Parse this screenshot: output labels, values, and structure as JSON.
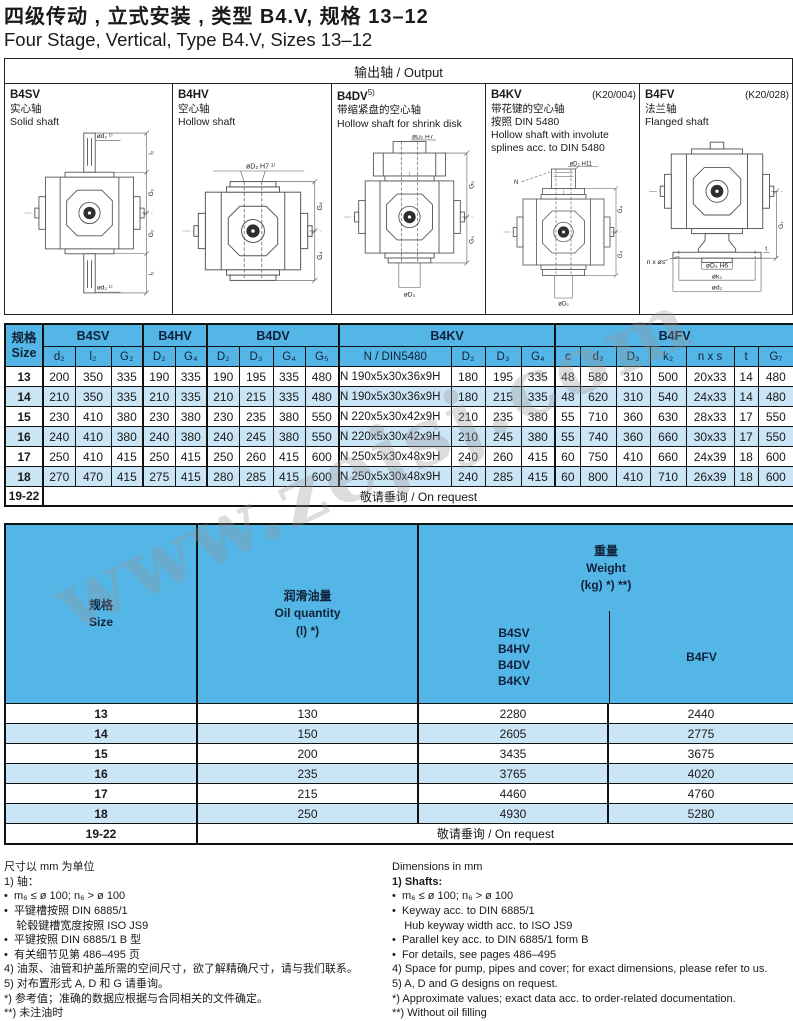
{
  "title": {
    "cn": "四级传动 , 立式安装 , 类型 B4.V, 规格 13–12",
    "en": "Four Stage, Vertical, Type B4.V, Sizes 13–12"
  },
  "watermark": {
    "text": "www.zejsj.com"
  },
  "output": {
    "header": "输出轴 / Output",
    "panels": [
      {
        "code": "B4SV",
        "sup": "",
        "ref": "",
        "lines": [
          "实心轴",
          "Solid shaft"
        ],
        "svg_labels": {
          "top": "ød₂ ¹⁾",
          "d1": "l₂",
          "d2": "G₂",
          "d3": "G₂",
          "d4": "l₂",
          "bottom": "ød₂ ¹⁾"
        }
      },
      {
        "code": "B4HV",
        "sup": "",
        "ref": "",
        "lines": [
          "空心轴",
          "Hollow shaft"
        ],
        "svg_labels": {
          "top": "øD₂ H7 ¹⁾",
          "d1": "G₄",
          "d2": "G₄"
        }
      },
      {
        "code": "B4DV",
        "sup": "5)",
        "ref": "",
        "lines": [
          "带缩紧盘的空心轴",
          "Hollow shaft for shrink disk"
        ],
        "svg_labels": {
          "top": "øD₂ H7",
          "d1": "G₅",
          "d2": "G₄",
          "bottom": "øD₃"
        }
      },
      {
        "code": "B4KV",
        "sup": "",
        "ref": "(K20/004)",
        "lines": [
          "带花键的空心轴",
          "按照 DIN 5480",
          "Hollow shaft with involute",
          "splines acc. to DIN 5480"
        ],
        "svg_labels": {
          "n": "N",
          "top": "øD₂ H11",
          "d1": "G₄",
          "d2": "G₄",
          "bottom": "øD₃"
        }
      },
      {
        "code": "B4FV",
        "sup": "",
        "ref": "(K20/028)",
        "lines": [
          "法兰轴",
          "Flanged shaft"
        ],
        "svg_labels": {
          "d1": "G₇",
          "f1": "øD₃ H6",
          "f2": "øk₂",
          "f3": "ød₂",
          "left": "n x øs",
          "t": "t"
        }
      }
    ]
  },
  "table1": {
    "size_header": {
      "cn": "规格",
      "en": "Size"
    },
    "groups": [
      "B4SV",
      "B4HV",
      "B4DV",
      "B4KV",
      "B4FV"
    ],
    "subheaders": [
      "d₂",
      "l₂",
      "G₂",
      "D₂",
      "G₄",
      "D₂",
      "D₃",
      "G₄",
      "G₅",
      "N / DIN5480",
      "D₂",
      "D₃",
      "G₄",
      "c",
      "d₂",
      "D₃",
      "k₂",
      "n x s",
      "t",
      "G₇"
    ],
    "rows": [
      {
        "size": "13",
        "values": [
          "200",
          "350",
          "335",
          "190",
          "335",
          "190",
          "195",
          "335",
          "480",
          "N 190x5x30x36x9H",
          "180",
          "195",
          "335",
          "48",
          "580",
          "310",
          "500",
          "20x33",
          "14",
          "480"
        ]
      },
      {
        "size": "14",
        "values": [
          "210",
          "350",
          "335",
          "210",
          "335",
          "210",
          "215",
          "335",
          "480",
          "N 190x5x30x36x9H",
          "180",
          "215",
          "335",
          "48",
          "620",
          "310",
          "540",
          "24x33",
          "14",
          "480"
        ]
      },
      {
        "size": "15",
        "values": [
          "230",
          "410",
          "380",
          "230",
          "380",
          "230",
          "235",
          "380",
          "550",
          "N 220x5x30x42x9H",
          "210",
          "235",
          "380",
          "55",
          "710",
          "360",
          "630",
          "28x33",
          "17",
          "550"
        ]
      },
      {
        "size": "16",
        "values": [
          "240",
          "410",
          "380",
          "240",
          "380",
          "240",
          "245",
          "380",
          "550",
          "N 220x5x30x42x9H",
          "210",
          "245",
          "380",
          "55",
          "740",
          "360",
          "660",
          "30x33",
          "17",
          "550"
        ]
      },
      {
        "size": "17",
        "values": [
          "250",
          "410",
          "415",
          "250",
          "415",
          "250",
          "260",
          "415",
          "600",
          "N 250x5x30x48x9H",
          "240",
          "260",
          "415",
          "60",
          "750",
          "410",
          "660",
          "24x39",
          "18",
          "600"
        ]
      },
      {
        "size": "18",
        "values": [
          "270",
          "470",
          "415",
          "275",
          "415",
          "280",
          "285",
          "415",
          "600",
          "N 250x5x30x48x9H",
          "240",
          "285",
          "415",
          "60",
          "800",
          "410",
          "710",
          "26x39",
          "18",
          "600"
        ]
      }
    ],
    "request": {
      "size": "19-22",
      "label": "敬请垂询 / On request"
    }
  },
  "table2": {
    "size_header": {
      "cn": "规格",
      "en": "Size"
    },
    "oil_header": {
      "cn": "润滑油量",
      "en": "Oil quantity",
      "unit": "(l) *)"
    },
    "weight_header": {
      "cn": "重量",
      "en": "Weight",
      "unit": "(kg) *) **)"
    },
    "weight_col1": [
      "B4SV",
      "B4HV",
      "B4DV",
      "B4KV"
    ],
    "weight_col2": "B4FV",
    "rows": [
      {
        "size": "13",
        "values": [
          "130",
          "2280",
          "2440"
        ]
      },
      {
        "size": "14",
        "values": [
          "150",
          "2605",
          "2775"
        ]
      },
      {
        "size": "15",
        "values": [
          "200",
          "3435",
          "3675"
        ]
      },
      {
        "size": "16",
        "values": [
          "235",
          "3765",
          "4020"
        ]
      },
      {
        "size": "17",
        "values": [
          "215",
          "4460",
          "4760"
        ]
      },
      {
        "size": "18",
        "values": [
          "250",
          "4930",
          "5280"
        ]
      }
    ],
    "request": {
      "size": "19-22",
      "label": "敬请垂询 / On request"
    }
  },
  "footnotes": {
    "cn": [
      {
        "t": "尺寸以 mm 为单位",
        "b": false
      },
      {
        "t": "1) 轴：",
        "b": false
      },
      {
        "t": "•  m₆ ≤ ø 100; n₆ > ø 100",
        "b": false
      },
      {
        "t": "•  平键槽按照 DIN 6885/1",
        "b": false
      },
      {
        "t": "    轮毂键槽宽度按照 ISO JS9",
        "b": false
      },
      {
        "t": "•  平键按照 DIN 6885/1 B 型",
        "b": false
      },
      {
        "t": "•  有关细节见第 486–495 页",
        "b": false
      },
      {
        "t": "4) 油泵、油管和护盖所需的空间尺寸，欲了解精确尺寸，请与我们联系。",
        "b": false
      },
      {
        "t": "5) 对布置形式 A, D 和 G 请垂询。",
        "b": false
      },
      {
        "t": "*) 参考值；准确的数据应根据与合同相关的文件确定。",
        "b": false
      },
      {
        "t": "**) 未注油时",
        "b": false
      }
    ],
    "en": [
      {
        "t": "Dimensions in mm",
        "b": false
      },
      {
        "t": "1) Shafts:",
        "b": true
      },
      {
        "t": "•  m₆ ≤ ø 100; n₆ > ø 100",
        "b": false
      },
      {
        "t": "•  Keyway acc. to DIN 6885/1",
        "b": false
      },
      {
        "t": "    Hub keyway width acc. to ISO JS9",
        "b": false
      },
      {
        "t": "•  Parallel key acc. to DIN 6885/1 form B",
        "b": false
      },
      {
        "t": "•  For details, see pages 486–495",
        "b": false
      },
      {
        "t": "4) Space for pump, pipes and cover; for exact dimensions, please refer to us.",
        "b": false
      },
      {
        "t": "5) A, D and G designs on request.",
        "b": false
      },
      {
        "t": "*) Approximate values; exact data acc. to order-related documentation.",
        "b": false
      },
      {
        "t": "**) Without oil filling",
        "b": false
      }
    ]
  },
  "colors": {
    "header_blue": "#54b6e6",
    "row_blue": "#c9e5f6",
    "border": "#111111"
  }
}
